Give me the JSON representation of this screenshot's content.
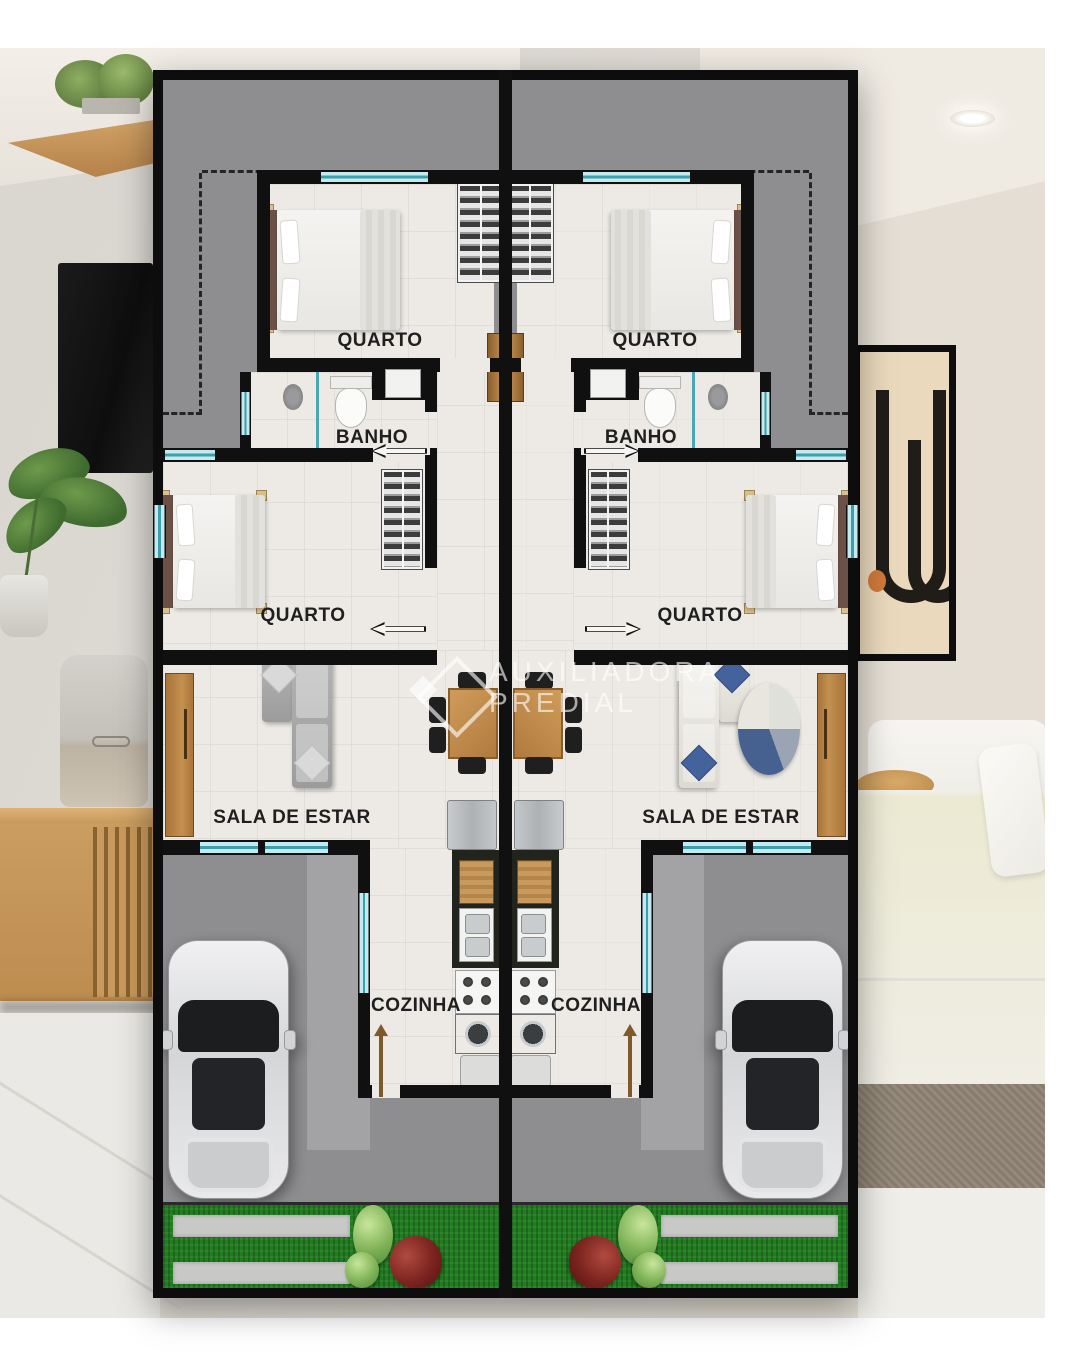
{
  "watermark": {
    "logo": "diamond-house-logo",
    "line1": "AUXILIADORA",
    "line2": "PREDIAL"
  },
  "floor_plan": {
    "units": [
      {
        "name": "unit-left",
        "rooms": [
          {
            "name": "bedroom-top",
            "label": "QUARTO"
          },
          {
            "name": "bathroom",
            "label": "BANHO"
          },
          {
            "name": "bedroom-middle",
            "label": "QUARTO"
          },
          {
            "name": "living-room",
            "label": "SALA DE ESTAR"
          },
          {
            "name": "kitchen",
            "label": "COZINHA"
          }
        ]
      },
      {
        "name": "unit-right",
        "rooms": [
          {
            "name": "bedroom-top",
            "label": "QUARTO"
          },
          {
            "name": "bathroom",
            "label": "BANHO"
          },
          {
            "name": "bedroom-middle",
            "label": "QUARTO"
          },
          {
            "name": "living-room",
            "label": "SALA DE ESTAR"
          },
          {
            "name": "kitchen",
            "label": "COZINHA"
          }
        ]
      }
    ]
  },
  "colors": {
    "wall": "#101010",
    "yard": "#8e8e90",
    "yardlight": "#a3a3a5",
    "floor": "#edeae5",
    "window_glass": "#c4e9ee",
    "window_frame": "#3b9fae",
    "grass": "#217d20",
    "paver": "#c8c8c6",
    "wood": "#b07a3e",
    "counter": "#20241c",
    "watermark": "rgba(255,255,255,0.62)"
  }
}
